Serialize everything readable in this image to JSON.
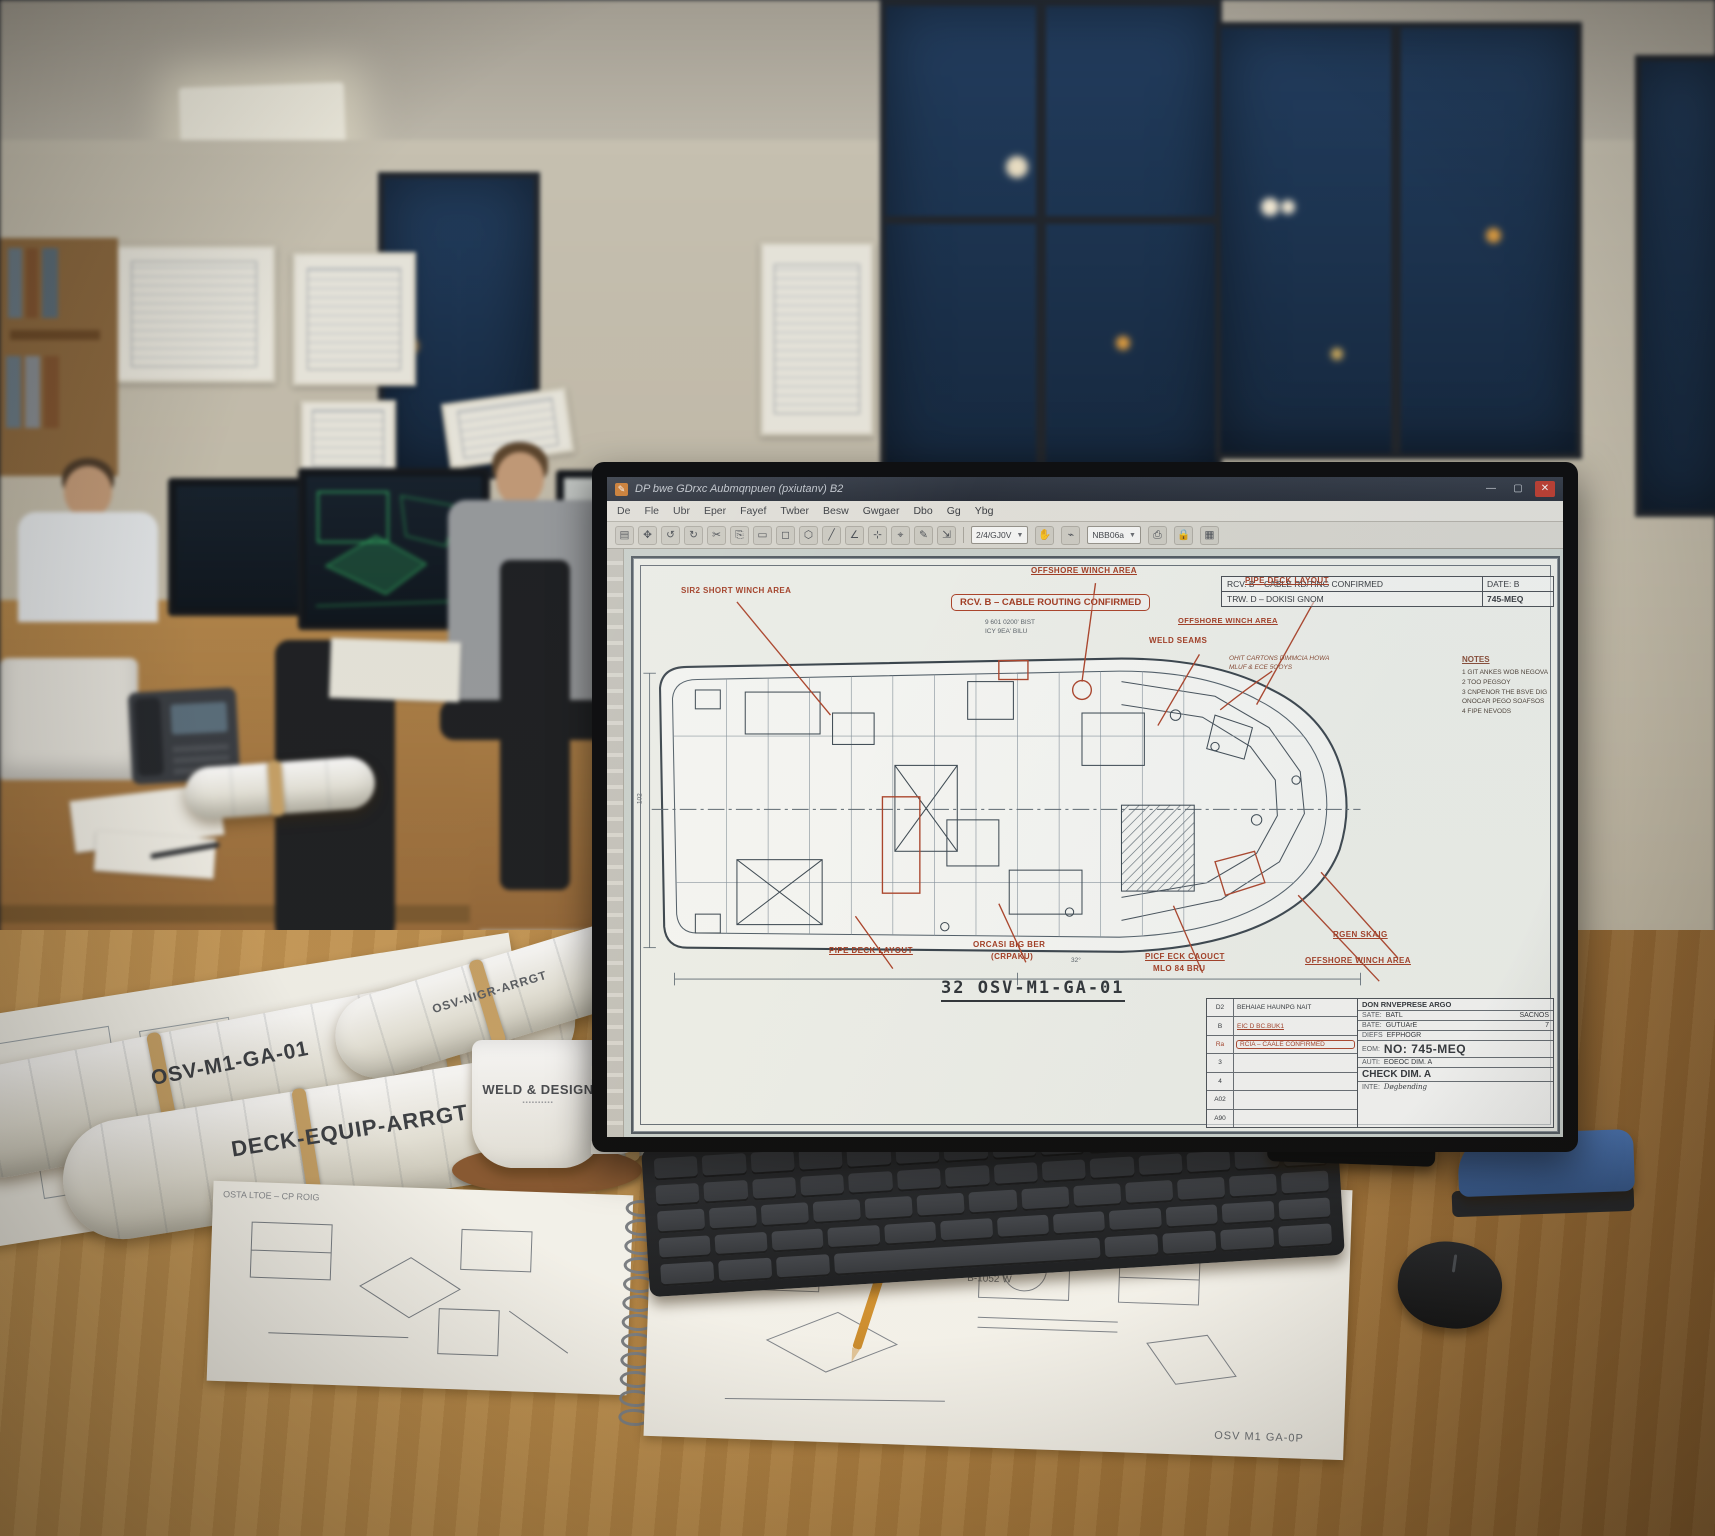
{
  "window": {
    "title": "DP bwe GDrxc Aubmqnpuen (pxiutanv) B2",
    "controls": {
      "minimize": "—",
      "maximize": "▢",
      "close": "✕"
    }
  },
  "menubar": {
    "items": [
      "De",
      "Fle",
      "Ubr",
      "Eper",
      "Fayef",
      "Twber",
      "Besw",
      "Gwgaer",
      "Dbo",
      "Gg",
      "Ybg"
    ]
  },
  "toolbar": {
    "icon_glyphs": "▤✥↺↻✂⎘▭◻⬡╱∠⊹⌖✎⇲",
    "zoom_value": "2/4/GJ0V",
    "layer_value": "NBB06a"
  },
  "drawing": {
    "stamp": "RCV. B – CABLE ROUTING CONFIRMED",
    "rev_table": {
      "rows": [
        {
          "desc": "RCV. B – CABLE RD/TING CONFIRMED",
          "date": "DATE:  B"
        },
        {
          "desc": "TRW. D – DOKISI GNOM",
          "date": "745-MEQ"
        }
      ]
    },
    "notes": {
      "title": "NOTES",
      "items": [
        "1  GIT ANKES WOB NEGOVA",
        "2  TOO PEGSOY",
        "3  CNPENOR THE BSVE DIG",
        "    ONOCAR PEGO SOAFSOS",
        "4  FIPE NEVODS"
      ]
    },
    "labels_top": [
      "SIR2 SHORT WINCH AREA",
      "OFFSHORE WINCH AREA",
      "WELD SEAMS",
      "PIPE DECK LAYOUT"
    ],
    "label_mid": "OFFSHORE WINCH AREA",
    "dim_note_1": "9 601 0200' BIST",
    "dim_note_2": "ICY 9EA' BILU",
    "handwritten_1": "OHIT CARTONS DIMMCIA HOWA",
    "handwritten_2": "MLUF & ECE 5OOYS",
    "labels_bottom": [
      "PIPE DECK LAYOUT",
      "ORCASI BIG BER",
      "(CRPAKU)",
      "PICF ECK CAOUCT",
      "MLO 84 BRU",
      "RGEN SKAIG",
      "OFFSHORE WINCH AREA"
    ],
    "left_dim": "102",
    "angle_note": "32°",
    "number": "32 OSV-M1-GA-01",
    "title_block": {
      "company": "DON RNVEPRESE ARGO",
      "fields": [
        {
          "label": "SATE:",
          "value": "BATL",
          "extra": "SACNOS"
        },
        {
          "label": "BATE:",
          "value": "GUTUArE",
          "extra": "7"
        },
        {
          "label": "DIEFS",
          "value": "EFPHOGR",
          "extra": ""
        },
        {
          "label": "AUTBE:",
          "value": "",
          "extra": ""
        }
      ],
      "dept_label": "EOM:",
      "number_big": "NO: 745-MEQ",
      "approve_label": "AUTI:",
      "approve_value": "EOEOC DIM. A",
      "check_big": "CHECK DIM. A",
      "footer_label": "INTE:",
      "footer_value": "Døgbending",
      "rev_history": [
        {
          "id": "D2",
          "desc": "BEHAIAE HAUNPG NAIT"
        },
        {
          "id": "B",
          "desc": "EIC D BC.BUK1"
        },
        {
          "id": "Ra",
          "desc": "RCIA – CAALE CONFIRMED"
        },
        {
          "id": "3",
          "desc": ""
        },
        {
          "id": "4",
          "desc": ""
        },
        {
          "id": "A02",
          "desc": ""
        },
        {
          "id": "A90",
          "desc": ""
        }
      ]
    }
  },
  "desk": {
    "roll_label_1": "OSV-M1-GA-01",
    "roll_label_2": "DECK-EQUIP-ARRGT",
    "roll_label_3": "OSV-NIGR-ARRGT",
    "mug_line_1": "WELD & DESIGN",
    "notebook_note": "OSTA LTOE – CP ROIG",
    "sheet_note_1": "B-1052 W",
    "sheet_note_2": "OSV M1 GA-0P"
  },
  "colors": {
    "annotation_red": "#a63c22",
    "window_night": "#1b3350",
    "desk_wood": "#b5874a",
    "close_red": "#c0392b"
  }
}
